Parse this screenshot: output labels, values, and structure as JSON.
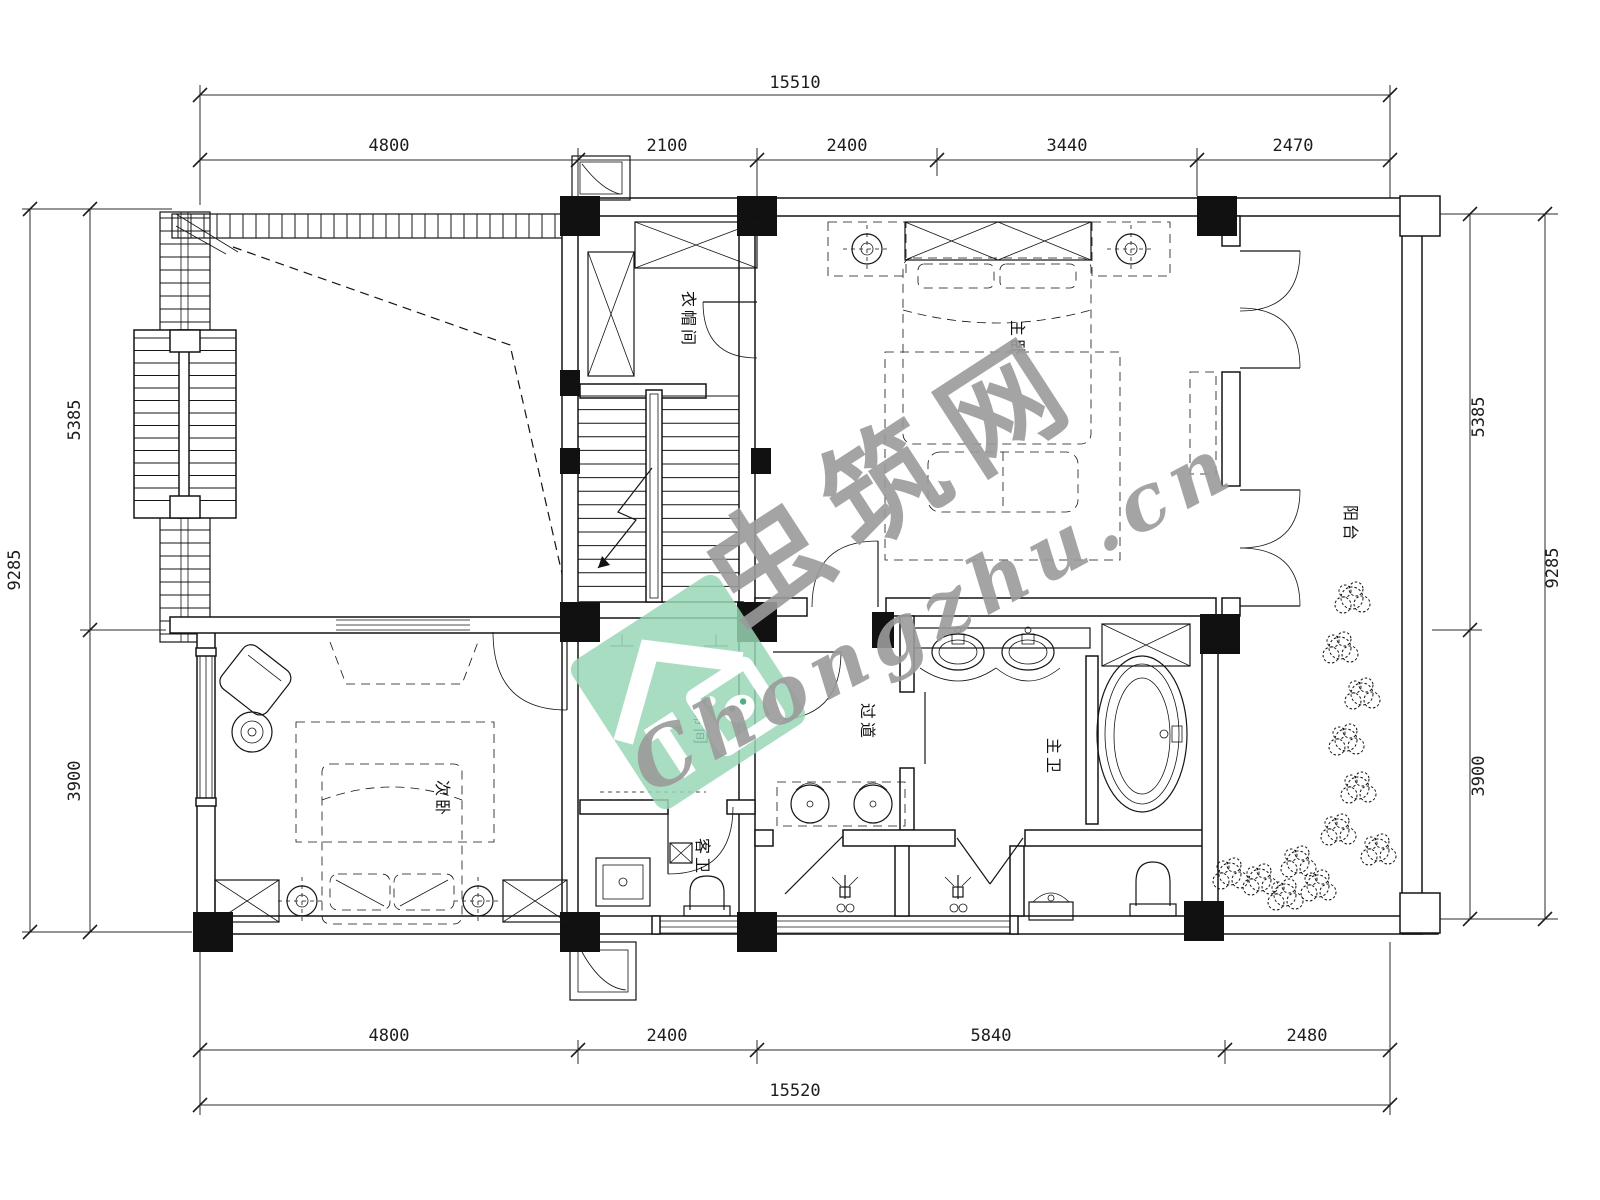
{
  "dims": {
    "top": {
      "total": "15510",
      "segments": [
        "4800",
        "2100",
        "2400",
        "3440",
        "2470"
      ]
    },
    "bottom": {
      "total": "15520",
      "segments": [
        "4800",
        "2400",
        "5840",
        "2480"
      ]
    },
    "left": {
      "total": "9285",
      "segments": [
        "5385",
        "3900"
      ]
    },
    "right": {
      "total": "9285",
      "segments": [
        "5385",
        "3900"
      ]
    }
  },
  "rooms": {
    "closet": "衣帽间",
    "master_bedroom": "主卧",
    "balcony": "阳台",
    "stairwell": "楼梯间",
    "corridor": "过道",
    "master_bath": "主卫",
    "guest_bath": "客卫",
    "second_bedroom": "次卧"
  },
  "watermark": {
    "brand_cn": "虫筑网",
    "brand_url": "Chongzhu.cn",
    "logo_color": "#98d7b6",
    "text_color": "#9b9b9b"
  }
}
